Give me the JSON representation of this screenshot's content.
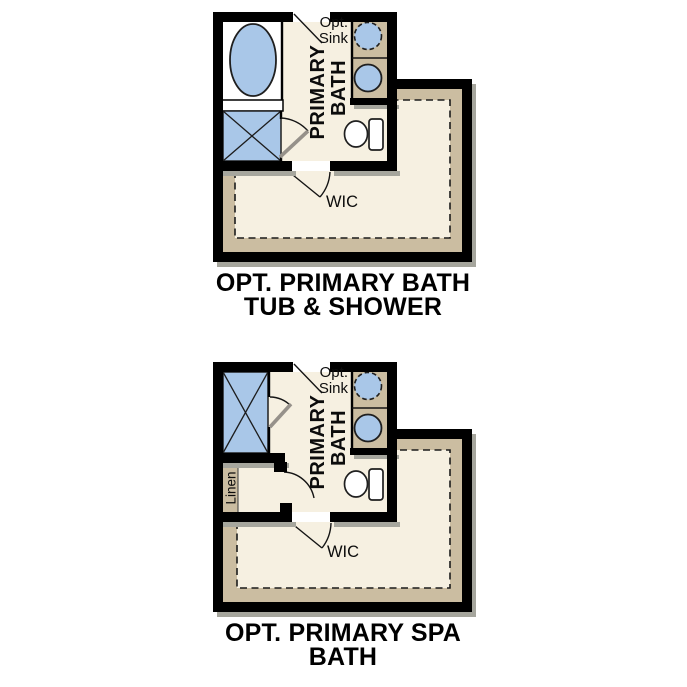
{
  "colors": {
    "wall": "#000000",
    "floor_cream": "#f6f0e1",
    "cabinet_tan": "#cbbda1",
    "fixture_blue": "#a9c7e8",
    "wall_shadow": "#a6a69d",
    "page_background": "#ffffff"
  },
  "plans": [
    {
      "id": "tub-shower",
      "labels": {
        "opt_sink_1": "Opt.",
        "opt_sink_2": "Sink",
        "room_1": "PRIMARY",
        "room_2": "BATH",
        "closet": "WIC"
      },
      "caption_1": "OPT. PRIMARY BATH",
      "caption_2": "TUB & SHOWER"
    },
    {
      "id": "spa-bath",
      "labels": {
        "opt_sink_1": "Opt.",
        "opt_sink_2": "Sink",
        "room_1": "PRIMARY",
        "room_2": "BATH",
        "closet": "WIC",
        "linen": "Linen"
      },
      "caption_1": "OPT. PRIMARY SPA",
      "caption_2": "BATH"
    }
  ]
}
